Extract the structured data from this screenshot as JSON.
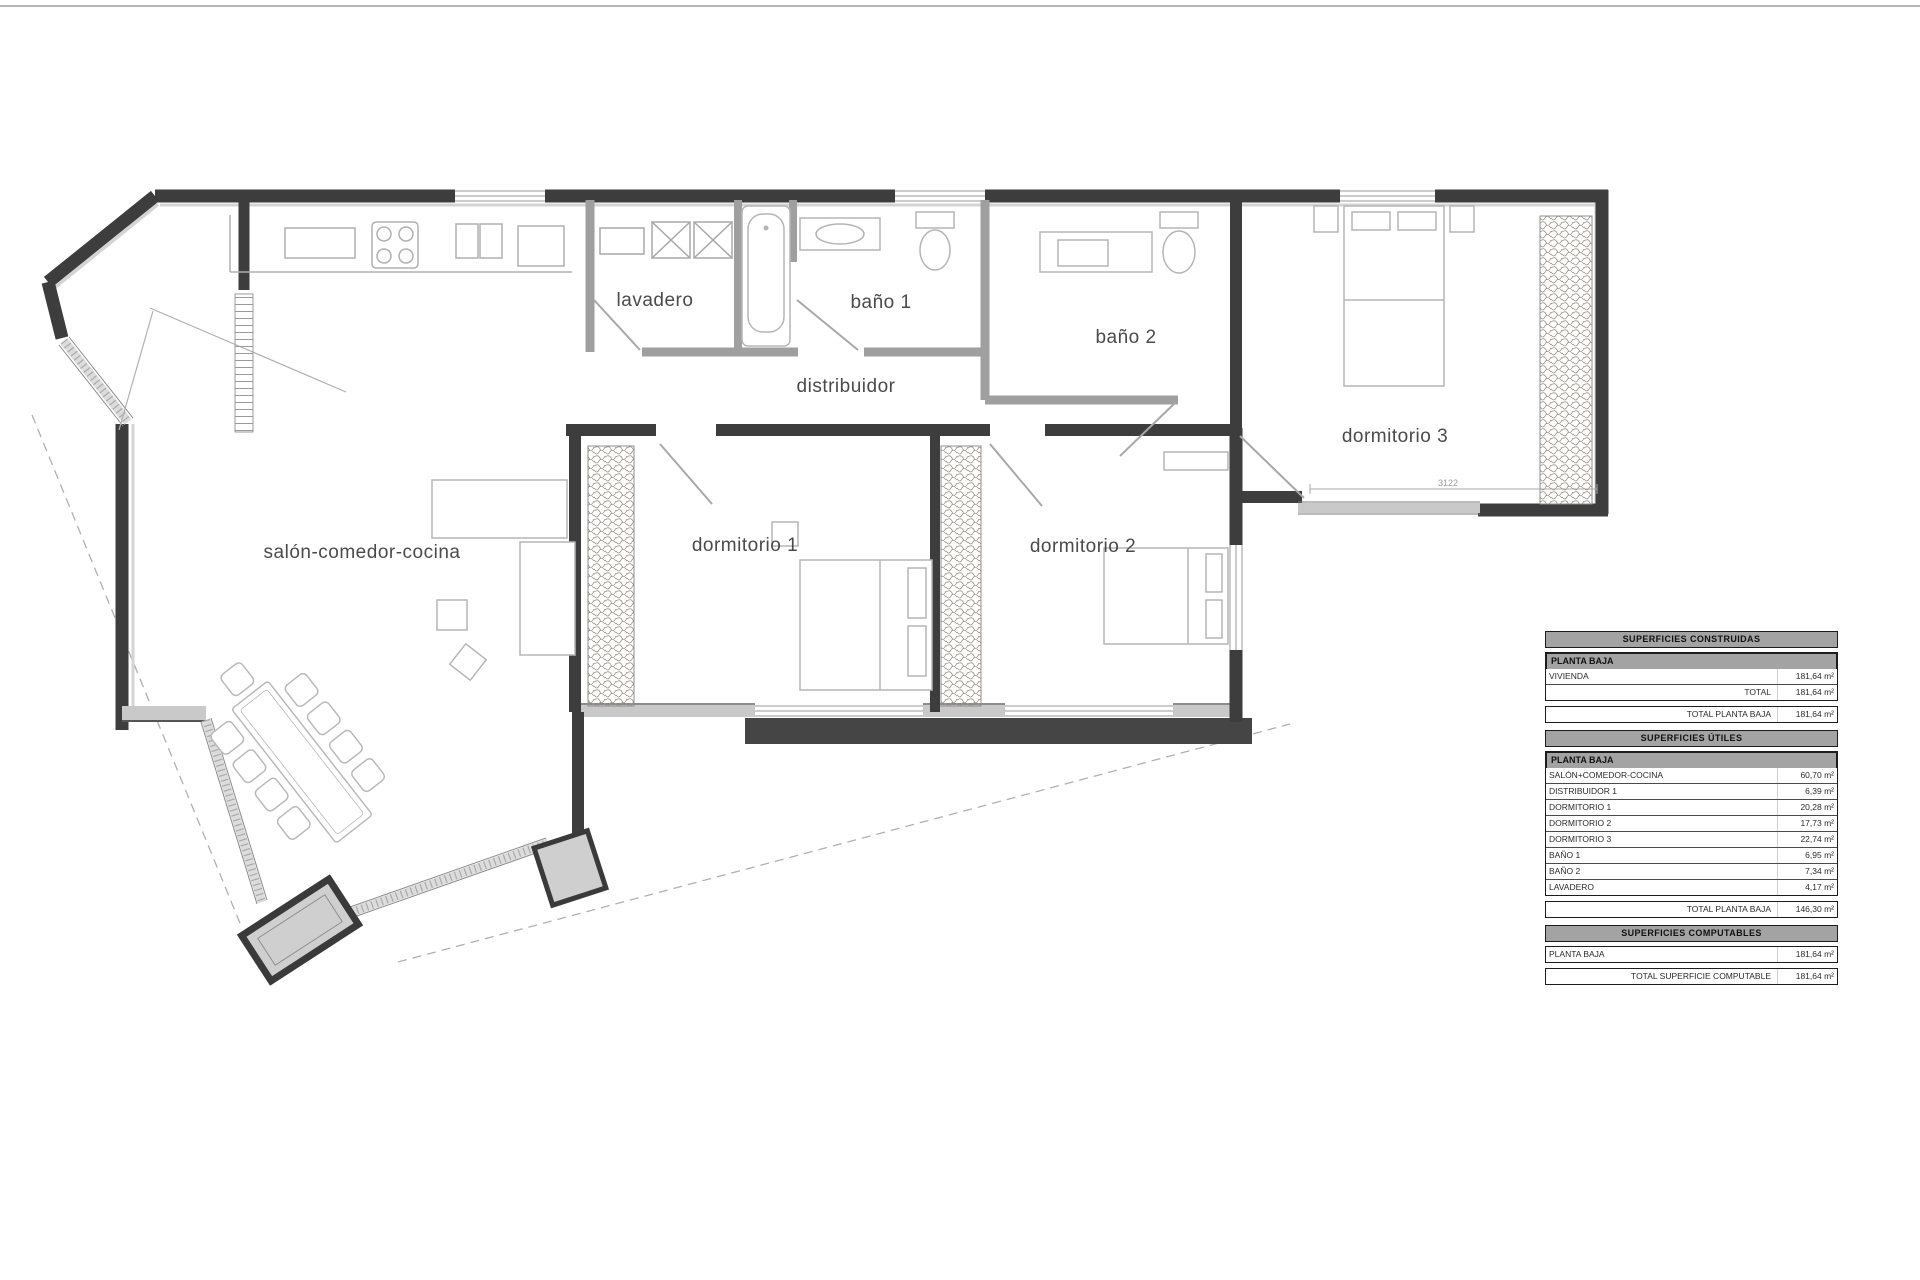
{
  "plan": {
    "rooms": [
      {
        "id": "lavadero",
        "label": "lavadero"
      },
      {
        "id": "bano1",
        "label": "baño 1"
      },
      {
        "id": "bano2",
        "label": "baño 2"
      },
      {
        "id": "distribuidor",
        "label": "distribuidor"
      },
      {
        "id": "dormitorio3",
        "label": "dormitorio 3"
      },
      {
        "id": "salon",
        "label": "salón-comedor-cocina"
      },
      {
        "id": "dormitorio1",
        "label": "dormitorio 1"
      },
      {
        "id": "dormitorio2",
        "label": "dormitorio 2"
      }
    ],
    "dimension_label": "3122",
    "colors": {
      "wall_dark": "#3d3d3d",
      "wall_gray": "#c9c9c9",
      "partition": "#9f9f9f",
      "furniture": "#b5b5b5"
    }
  },
  "surface_tables": [
    {
      "header": "SUPERFICIES CONSTRUIDAS",
      "blocks": [
        {
          "type": "subheader",
          "label": "PLANTA BAJA"
        },
        {
          "type": "row",
          "label": "VIVIENDA",
          "right_label": "",
          "value": "181,64 m²"
        },
        {
          "type": "row",
          "label": "",
          "right_label": "TOTAL",
          "value": "181,64 m²"
        },
        {
          "type": "total",
          "right_label": "TOTAL PLANTA BAJA",
          "value": "181,64 m²"
        }
      ]
    },
    {
      "header": "SUPERFICIES ÚTILES",
      "blocks": [
        {
          "type": "subheader",
          "label": "PLANTA BAJA"
        },
        {
          "type": "row",
          "label": "SALÓN+COMEDOR-COCINA",
          "right_label": "",
          "value": "60,70 m²"
        },
        {
          "type": "row",
          "label": "DISTRIBUIDOR 1",
          "right_label": "",
          "value": "6,39 m²"
        },
        {
          "type": "row",
          "label": "DORMITORIO 1",
          "right_label": "",
          "value": "20,28 m²"
        },
        {
          "type": "row",
          "label": "DORMITORIO 2",
          "right_label": "",
          "value": "17,73 m²"
        },
        {
          "type": "row",
          "label": "DORMITORIO 3",
          "right_label": "",
          "value": "22,74 m²"
        },
        {
          "type": "row",
          "label": "BAÑO 1",
          "right_label": "",
          "value": "6,95 m²"
        },
        {
          "type": "row",
          "label": "BAÑO 2",
          "right_label": "",
          "value": "7,34 m²"
        },
        {
          "type": "row",
          "label": "LAVADERO",
          "right_label": "",
          "value": "4,17 m²"
        },
        {
          "type": "total",
          "right_label": "TOTAL PLANTA BAJA",
          "value": "146,30 m²"
        }
      ]
    },
    {
      "header": "SUPERFICIES COMPUTABLES",
      "blocks": [
        {
          "type": "row",
          "label": "PLANTA BAJA",
          "right_label": "",
          "value": "181,64 m²"
        },
        {
          "type": "total",
          "right_label": "TOTAL SUPERFICIE COMPUTABLE",
          "value": "181,64 m²"
        }
      ]
    }
  ]
}
